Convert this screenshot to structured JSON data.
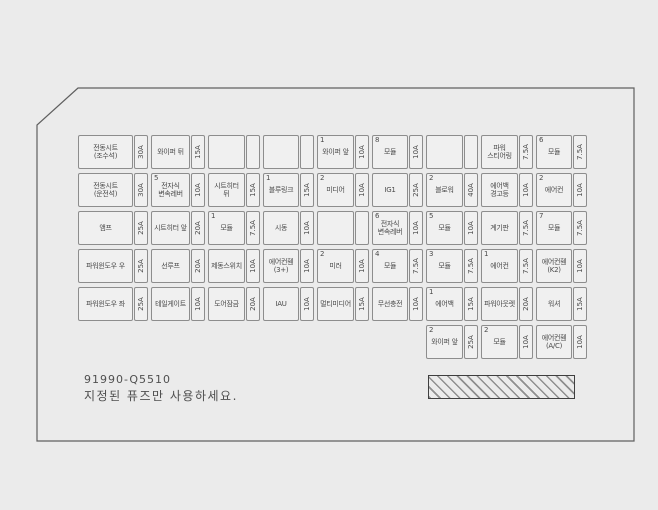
{
  "colors": {
    "background": "#ebebeb",
    "panel_line": "#5f5f5f",
    "cell_border": "#8d8d8d",
    "text": "#4a4a4a"
  },
  "footer": {
    "part_number": "91990-Q5510",
    "notice": "지정된 퓨즈만 사용하세요."
  },
  "fuse_grid": {
    "rows": [
      {
        "offset": 0,
        "cells": [
          {
            "num": "",
            "label": "전동시트 (조수석)",
            "amp": "30A"
          },
          {
            "num": "",
            "label": "와이퍼 뒤",
            "amp": "15A"
          },
          {
            "num": "",
            "label": "",
            "amp": ""
          },
          {
            "num": "",
            "label": "",
            "amp": ""
          },
          {
            "num": "1",
            "label": "와이퍼 앞",
            "amp": "10A"
          },
          {
            "num": "8",
            "label": "모듈",
            "amp": "10A"
          },
          {
            "num": "",
            "label": "",
            "amp": ""
          },
          {
            "num": "",
            "label": "파워 스티어링",
            "amp": "7.5A"
          },
          {
            "num": "6",
            "label": "모듈",
            "amp": "7.5A"
          }
        ]
      },
      {
        "offset": 0,
        "cells": [
          {
            "num": "",
            "label": "전동시트 (운전석)",
            "amp": "30A"
          },
          {
            "num": "5",
            "label": "전자식 변속레버",
            "amp": "10A"
          },
          {
            "num": "",
            "label": "시트히터 뒤",
            "amp": "15A"
          },
          {
            "num": "1",
            "label": "블루링크",
            "amp": "15A"
          },
          {
            "num": "2",
            "label": "미디어",
            "amp": "10A"
          },
          {
            "num": "",
            "label": "IG1",
            "amp": "25A"
          },
          {
            "num": "2",
            "label": "블로워",
            "amp": "40A"
          },
          {
            "num": "",
            "label": "에어백 경고등",
            "amp": "10A"
          },
          {
            "num": "2",
            "label": "에어컨",
            "amp": "10A"
          }
        ]
      },
      {
        "offset": 0,
        "cells": [
          {
            "num": "",
            "label": "앰프",
            "amp": "25A"
          },
          {
            "num": "",
            "label": "시트히터 앞",
            "amp": "20A"
          },
          {
            "num": "1",
            "label": "모듈",
            "amp": "7.5A"
          },
          {
            "num": "",
            "label": "시동",
            "amp": "10A"
          },
          {
            "num": "",
            "label": "",
            "amp": ""
          },
          {
            "num": "6",
            "label": "전자식 변속레버",
            "amp": "10A"
          },
          {
            "num": "5",
            "label": "모듈",
            "amp": "10A"
          },
          {
            "num": "",
            "label": "계기판",
            "amp": "7.5A"
          },
          {
            "num": "7",
            "label": "모듈",
            "amp": "7.5A"
          }
        ]
      },
      {
        "offset": 0,
        "cells": [
          {
            "num": "",
            "label": "파워윈도우 우",
            "amp": "25A"
          },
          {
            "num": "",
            "label": "선루프",
            "amp": "20A"
          },
          {
            "num": "",
            "label": "제동스위치",
            "amp": "10A"
          },
          {
            "num": "",
            "label": "에어컨휀 (3+)",
            "amp": "10A"
          },
          {
            "num": "2",
            "label": "미러",
            "amp": "10A"
          },
          {
            "num": "4",
            "label": "모듈",
            "amp": "7.5A"
          },
          {
            "num": "3",
            "label": "모듈",
            "amp": "7.5A"
          },
          {
            "num": "1",
            "label": "에어컨",
            "amp": "7.5A"
          },
          {
            "num": "",
            "label": "에어컨휀 (K2)",
            "amp": "10A"
          }
        ]
      },
      {
        "offset": 0,
        "cells": [
          {
            "num": "",
            "label": "파워윈도우 좌",
            "amp": "25A"
          },
          {
            "num": "",
            "label": "테일게이트",
            "amp": "10A"
          },
          {
            "num": "",
            "label": "도어잠금",
            "amp": "20A"
          },
          {
            "num": "",
            "label": "IAU",
            "amp": "10A"
          },
          {
            "num": "",
            "label": "멀티미디어",
            "amp": "15A"
          },
          {
            "num": "",
            "label": "무선충전",
            "amp": "10A"
          },
          {
            "num": "1",
            "label": "에어백",
            "amp": "15A"
          },
          {
            "num": "",
            "label": "파워아웃렛",
            "amp": "20A"
          },
          {
            "num": "",
            "label": "워셔",
            "amp": "15A"
          }
        ]
      },
      {
        "offset": 6,
        "cells": [
          {
            "num": "2",
            "label": "와이퍼 앞",
            "amp": "25A"
          },
          {
            "num": "2",
            "label": "모듈",
            "amp": "10A"
          },
          {
            "num": "",
            "label": "에어컨휀 (A/C)",
            "amp": "10A"
          }
        ]
      }
    ]
  }
}
